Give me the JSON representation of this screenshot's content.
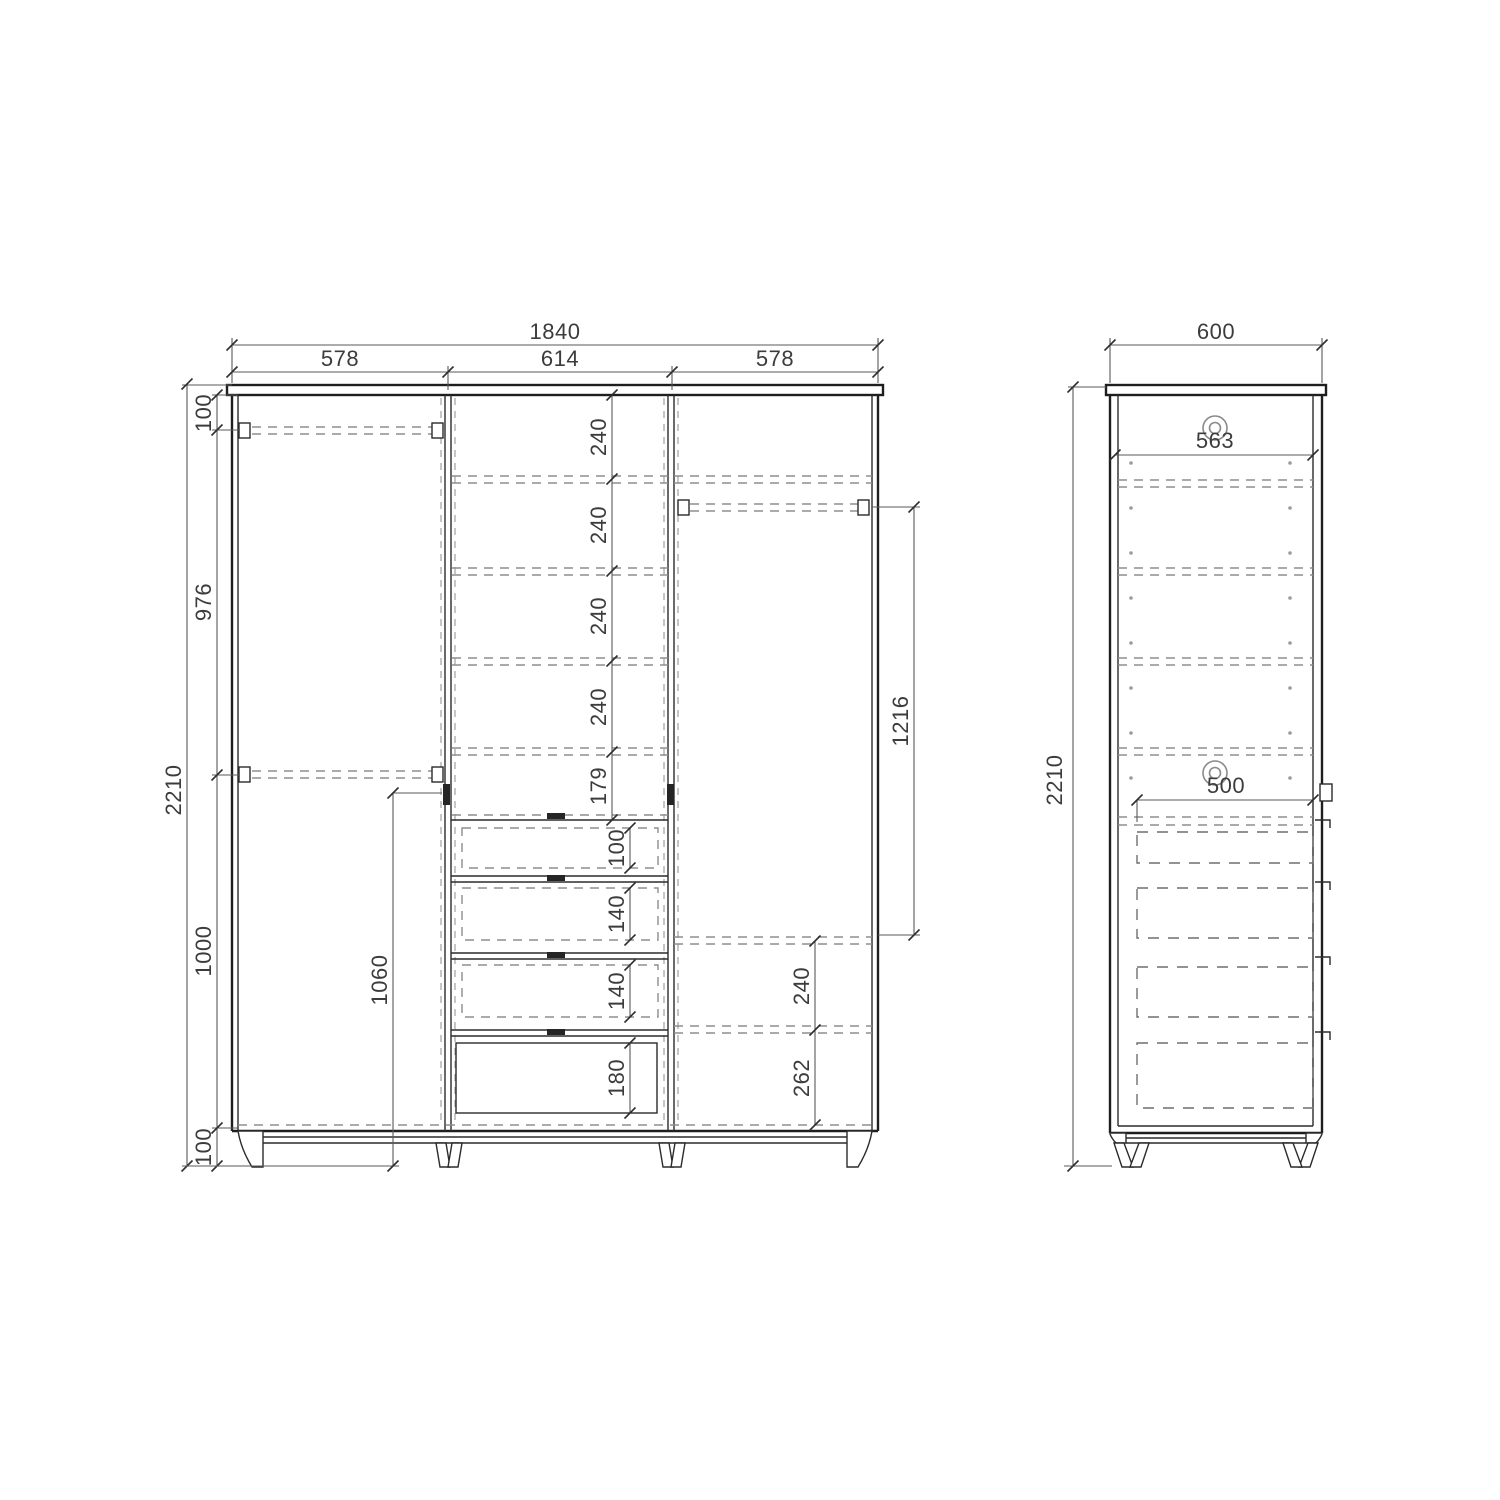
{
  "front_view": {
    "overall_width": "1840",
    "section_widths": [
      "578",
      "614",
      "578"
    ],
    "overall_height": "2210",
    "height_chain": {
      "top": "100",
      "upper": "976",
      "lower": "1000",
      "base": "100"
    },
    "shelf_chain": [
      "240",
      "240",
      "240",
      "240",
      "179"
    ],
    "drawer_heights": [
      "100",
      "140",
      "140",
      "180"
    ],
    "rail_to_shelf": "1216",
    "right_shelf_gap": "240",
    "right_bottom_gap": "262",
    "hinge_height": "1060"
  },
  "side_view": {
    "overall_depth": "600",
    "interior_depth": "563",
    "drawer_depth": "500",
    "overall_height": "2210"
  }
}
